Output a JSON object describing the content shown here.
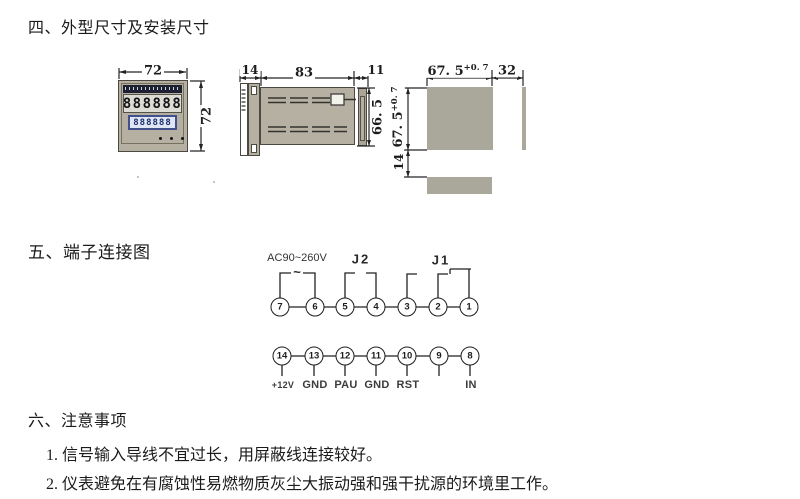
{
  "sections": {
    "dimensions": {
      "title": "四、外型尺寸及安装尺寸"
    },
    "terminals": {
      "title": "五、端子连接图"
    },
    "notes": {
      "title": "六、注意事项",
      "items": [
        "1. 信号输入导线不宜过长，用屏蔽线连接较好。",
        "2. 仪表避免在有腐蚀性易燃物质灰尘大振动强和强干扰源的环境里工作。"
      ]
    }
  },
  "front_view": {
    "width_label": "72",
    "height_label": "72",
    "upper_display": "888888",
    "lower_display": "888888"
  },
  "side_view": {
    "front_depth": "14",
    "body_length": "83",
    "rear_depth": "11",
    "height": "66. 5"
  },
  "cutout_view": {
    "width": "67. 5",
    "width_tol": "+0. 7",
    "side_gap": "32",
    "height": "67. 5",
    "height_tol": "+0. 7",
    "bottom_gap": "14"
  },
  "terminal_diagram": {
    "power_label": "AC90~260V",
    "power_symbol": "~",
    "j2_label": "J2",
    "j1_label": "J1",
    "top_terminals": [
      "7",
      "6",
      "5",
      "4",
      "3",
      "2",
      "1"
    ],
    "bottom_terminals": [
      "14",
      "13",
      "12",
      "11",
      "10",
      "9",
      "8"
    ],
    "bottom_labels": [
      "+12V",
      "GND",
      "PAU",
      "GND",
      "RST",
      "",
      "IN"
    ]
  },
  "colors": {
    "device_tan": "#b5b0a2",
    "cutout_gray": "#a9a89b",
    "line": "#26262a",
    "lcd_border": "#41518c",
    "lcd_bg": "#dfe5f2",
    "brand_strip": "#1c2030"
  }
}
